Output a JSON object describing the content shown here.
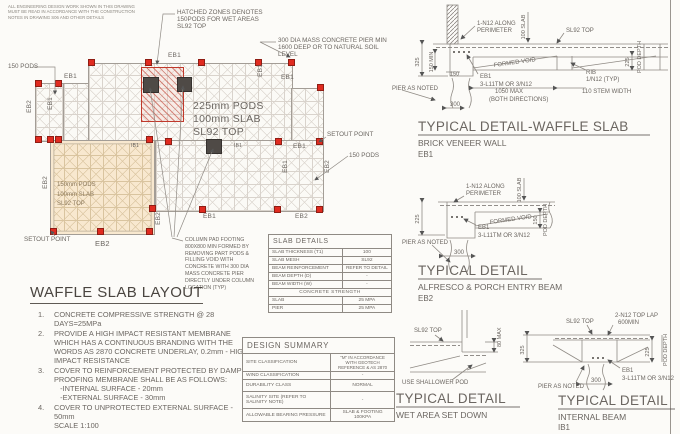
{
  "colors": {
    "marker_red": "#e02b20",
    "hatch_red": "#c0392b",
    "orange_zone": "#f8e8cf",
    "column_dark": "#4f4a46",
    "line_gray": "#8f8a84"
  },
  "disclaimer": "ALL ENGINEERING DESIGN WORK SHOWN IN THIS DRAWING\nMUST BE READ IN ACCORDANCE WITH THE CONSTRUCTION\nNOTES IN DRAWING S06 AND OTHER DETAILS",
  "plan": {
    "zone_labels": {
      "main": "225mm PODS\n100mm SLAB\nSL92 TOP",
      "alfresco": "150mm PODS\n100mm SLAB\nSL92 TOP"
    },
    "annotations": {
      "hatched": "HATCHED ZONES DENOTES\n150PODS FOR WET AREAS\nSL92 TOP",
      "pier": "300 DIA MASS CONCRETE PIER MIN\n1600 DEEP OR TO NATURAL SOIL\nLEVEL",
      "pods_left": "150 PODS",
      "pods_right": "150 PODS",
      "setout_right": "SETOUT POINT",
      "setout_bottom": "SETOUT POINT",
      "column_pad": "COLUMN PAD FOOTING\n800X800 MIN FORMED BY\nREMOVING PART PODS &\nFILLING VOID WITH\nCONCRETE WITH 300 DIA\nMASS CONCRETE PIER\nDIRECTLY UNDER COLUMN\nLOCATION (TYP)"
    },
    "beams": {
      "top": "EB1",
      "leftbay_top": "EB1",
      "right_top": "EB1",
      "step_v": "EB1",
      "left_v": "EB2",
      "inbay_v": "EB1",
      "left_lower_v": "EB2",
      "mid_a": "IB1",
      "mid_b": "IB1",
      "mid_right": "EB1",
      "bay_v": "EB1",
      "right_v": "EB2",
      "step2_v": "EB2",
      "bottom": "EB1",
      "bottom_right": "EB2",
      "bottom_orange": "EB2"
    }
  },
  "notes": {
    "title": "WAFFLE SLAB LAYOUT",
    "items": [
      {
        "num": "1.",
        "text": "CONCRETE COMPRESSIVE STRENGTH @ 28 DAYS=25MPa"
      },
      {
        "num": "2.",
        "text": "PROVIDE A HIGH IMPACT RESISTANT MEMBRANE WHICH HAS A CONTINUOUS BRANDING WITH THE WORDS AS 2870 CONCRETE UNDERLAY, 0.2mm - HIGH IMPACT RESISTANCE"
      },
      {
        "num": "3.",
        "text": "COVER TO REINFORCEMENT PROTECTED BY DAMP PROOFING MEMBRANE SHALL BE AS FOLLOWS:\n   -INTERNAL SURFACE - 20mm\n   -EXTERNAL SURFACE - 30mm"
      },
      {
        "num": "4.",
        "text": "COVER TO UNPROTECTED EXTERNAL SURFACE - 50mm\nSCALE 1:100"
      }
    ]
  },
  "slab_details": {
    "title": "SLAB DETAILS",
    "rows": [
      [
        "SLAB THICKNESS (T1)",
        "100"
      ],
      [
        "SLAB MESH",
        "SL92"
      ],
      [
        "BEAM REINFORCEMENT",
        "REFER TO DETAIL"
      ],
      [
        "BEAM DEPTH (D)",
        "-"
      ],
      [
        "BEAM WIDTH (W)",
        "-"
      ]
    ],
    "strength_header": "CONCRETE STRENGTH",
    "strength_rows": [
      [
        "SLAB",
        "25 MPa"
      ],
      [
        "PIER",
        "25 MPa"
      ]
    ]
  },
  "design_summary": {
    "title": "DESIGN SUMMARY",
    "rows": [
      [
        "SITE CLASSIFICATION",
        "\"M\" IN ACCORDANCE WITH GEOTECH REFERENCE & AS 2870"
      ],
      [
        "WIND CLASSIFICATION",
        "-"
      ],
      [
        "DURABILITY CLASS",
        "NORMAL"
      ],
      [
        "SALINITY SITE (REFER TO SALINITY NOTE)",
        "-"
      ],
      [
        "ALLOWABLE BEARING PRESSURE",
        "SLAB & FOOTING 100kPa"
      ]
    ]
  },
  "details": {
    "waffle": {
      "title": "TYPICAL DETAIL-WAFFLE SLAB",
      "subtitle": "BRICK VENEER WALL",
      "ref": "EB1",
      "n12_1": "1-N12 ALONG",
      "n12_2": "PERIMETER",
      "slab100": "100 SLAB",
      "sl92": "SL92 TOP",
      "formed_void": "FORMED VOID",
      "dim325": "325",
      "dim150min": "150 MIN",
      "dim150": "150",
      "eb1": "EB1",
      "bars": "3-L11TM OR 3/N12",
      "rib": "RIB",
      "rib_bar": "1/N12 (TYP)",
      "max1050": "1050 MAX",
      "both": "(BOTH DIRECTIONS)",
      "stem": "110 STEM WIDTH",
      "pier": "PIER AS NOTED",
      "dim300": "300",
      "dim225": "225",
      "pod_depth": "POD DEPTH"
    },
    "alfresco": {
      "title": "TYPICAL DETAIL",
      "subtitle": "ALFRESCO & PORCH ENTRY BEAM",
      "ref": "EB2",
      "n12_1": "1-N12 ALONG",
      "n12_2": "PERIMETER",
      "slab100": "100 SLAB",
      "formed_void": "FORMED VOID",
      "dim225": "225",
      "dim150": "150",
      "pod_depth": "POD DEPTH",
      "eb1": "EB1",
      "bars": "3-L11TM OR 3/N12",
      "pier": "PIER AS NOTED",
      "dim300": "300"
    },
    "wet": {
      "title": "TYPICAL DETAIL",
      "subtitle": "WET AREA SET DOWN",
      "sl92": "SL92 TOP",
      "max80": "80 MAX",
      "pod": "USE SHALLOWER POD"
    },
    "internal": {
      "title": "TYPICAL DETAIL",
      "subtitle": "INTERNAL BEAM",
      "ref": "IB1",
      "sl92": "SL92 TOP",
      "lap1": "2-N12 TOP LAP",
      "lap2": "600MIN",
      "dim325": "325",
      "eb1": "EB1",
      "bars": "3-L11TM OR 3/N12",
      "pier": "PIER AS NOTED",
      "dim300": "300",
      "dim225": "225",
      "pod_depth": "POD DEPTH"
    }
  }
}
